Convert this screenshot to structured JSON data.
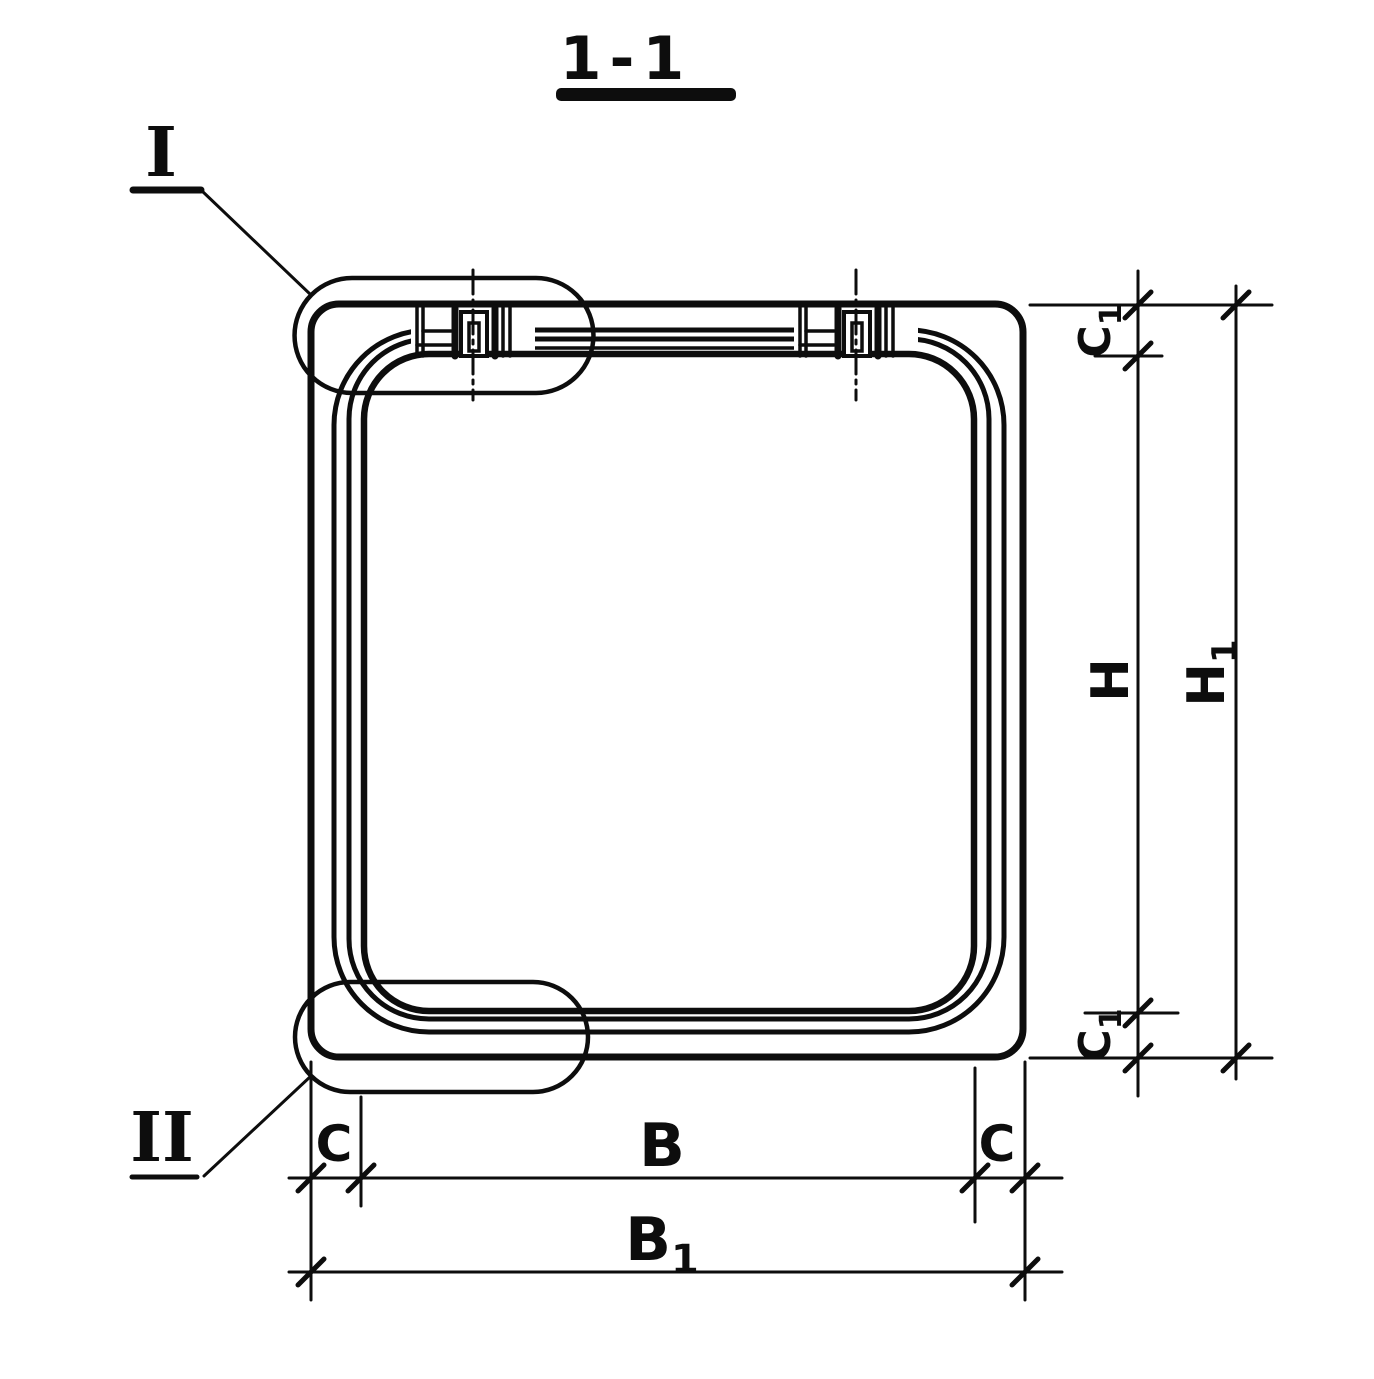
{
  "drawing": {
    "title": "1-1"
  },
  "details": {
    "i": "I",
    "ii": "II"
  },
  "dims": {
    "c1_top": {
      "base": "C",
      "sub": "1"
    },
    "h": {
      "base": "H"
    },
    "h1": {
      "base": "H",
      "sub": "1"
    },
    "c1_bottom": {
      "base": "C",
      "sub": "1"
    },
    "c_left": {
      "base": "C"
    },
    "b": {
      "base": "B"
    },
    "c_right": {
      "base": "C"
    },
    "b1": {
      "base": "B",
      "sub": "1"
    }
  },
  "style": {
    "ink": "#0d0d0d",
    "paper": "#ffffff"
  }
}
